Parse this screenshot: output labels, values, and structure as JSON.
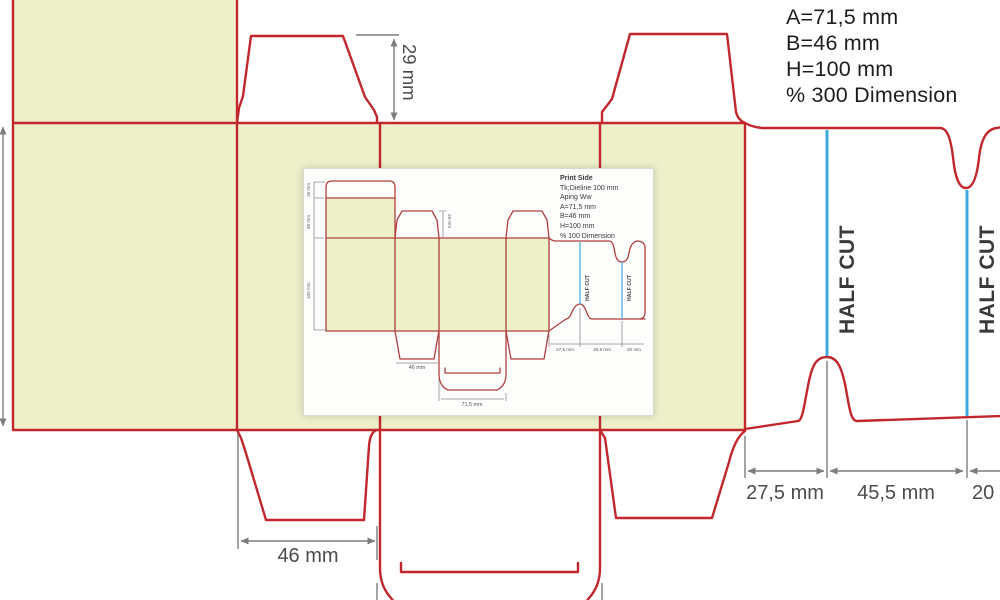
{
  "colors": {
    "cut_line": "#c1272d",
    "panel_fill": "#eef0ca",
    "half_cut_line": "#3fa9dc",
    "dimension_gray": "#7b7d81",
    "label_text": "#4a4b4d",
    "info_text": "#1d1d1f"
  },
  "info_panel": {
    "lines": [
      "A=71,5 mm",
      "B=46 mm",
      "H=100 mm",
      "% 300 Dimension"
    ]
  },
  "main_drawing": {
    "top_flap_dim": "29 mm",
    "bottom_flap_dim": "46 mm",
    "glue_dims": [
      "27,5 mm",
      "45,5 mm",
      "20 mm"
    ],
    "half_cut_labels": [
      "HALF CUT",
      "HALF CUT"
    ]
  },
  "inset": {
    "text_block": [
      "Print Side",
      "Tk;Dieline 100 mm",
      "Aping Ww",
      "A=71,5 mm",
      "B=46 mm",
      "H=100 mm",
      "% 100 Dimension"
    ],
    "left_dims": [
      "16 mm",
      "46 mm",
      "100 mm"
    ],
    "top_flap_dim": "29 mm",
    "bottom_flap_dim": "46 mm",
    "tuck_dim": "71,5 mm",
    "glue_dims": [
      "27,5 mm",
      "45,5 mm",
      "20 mm"
    ],
    "half_cut_labels": [
      "HALF CUT",
      "HALF CUT"
    ]
  }
}
